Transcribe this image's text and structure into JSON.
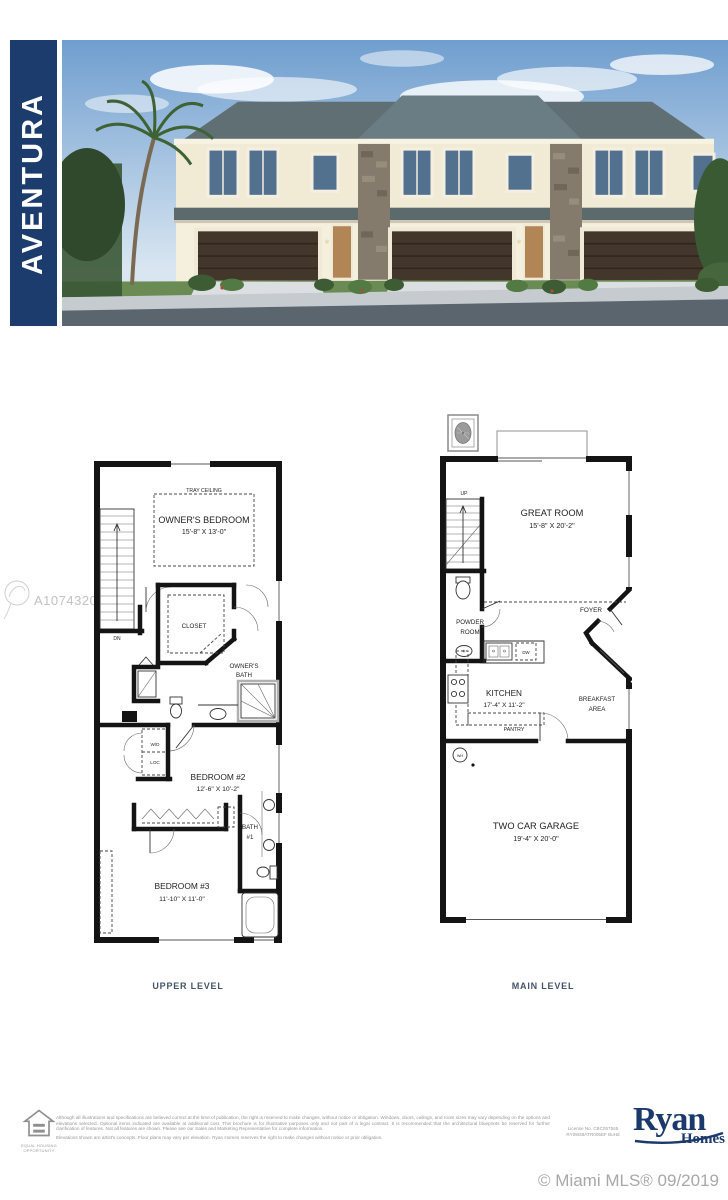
{
  "page": {
    "title_banner": "AVENTURA"
  },
  "mls": {
    "watermark_id": "A10743204",
    "copyright": "© Miami MLS® 09/2019"
  },
  "plans": {
    "upper": {
      "caption": "UPPER LEVEL",
      "labels": {
        "tray_ceiling": "TRAY CEILING",
        "owners_bedroom": "OWNER'S BEDROOM",
        "owners_bedroom_dims": "15'-8\" X 13'-0\"",
        "dn": "DN",
        "closet": "CLOSET",
        "owners_bath_l1": "OWNER'S",
        "owners_bath_l2": "BATH",
        "wd": "W/D",
        "loc": "LOC",
        "bedroom2": "BEDROOM #2",
        "bedroom2_dims": "12'-6\" X 10'-2\"",
        "bath1_l1": "BATH",
        "bath1_l2": "#1",
        "bedroom3": "BEDROOM #3",
        "bedroom3_dims": "11'-10\" X 11'-0\""
      }
    },
    "main": {
      "caption": "MAIN LEVEL",
      "labels": {
        "up": "UP",
        "great_room": "GREAT ROOM",
        "great_room_dims": "15'-8\" X 20'-2\"",
        "powder_l1": "POWDER",
        "powder_l2": "ROOM",
        "foyer": "FOYER",
        "kitchen": "KITCHEN",
        "kitchen_dims": "17'-4\" X 11'-2\"",
        "dw": "DW",
        "pantry": "PANTRY",
        "breakfast_l1": "BREAKFAST",
        "breakfast_l2": "AREA",
        "wh": "WH",
        "garage": "TWO CAR GARAGE",
        "garage_dims": "19'-4\" X 20'-0\""
      }
    }
  },
  "footer": {
    "disclaimer_p1": "Although all illustrations and specifications are believed correct at the time of publication, the right is reserved to make changes, without notice or obligation. Windows, doors, ceilings, and room sizes may vary depending on the options and elevations selected. Optional items indicated are available at additional cost. This brochure is for illustrative purposes only and not part of a legal contract. It is recommended that the architectural blueprints be reserved for further clarification of features. Not all features are shown. Please see our Sales and Marketing Representative for complete information.",
    "disclaimer_p2": "Elevations shown are artist's concepts. Floor plans may vary per elevation. Ryan Homes reserves the right to make changes without notice or prior obligation.",
    "license_l1": "License No. CBC057565",
    "license_l2": "RY09GBATR005EF BuHd",
    "brand_l1": "Ryan",
    "brand_l2": "Homes",
    "equal_housing_caption": "EQUAL HOUSING OPPORTUNITY"
  },
  "colors": {
    "banner_blue": "#1d3c6e",
    "brand_navy": "#1b3a6b",
    "caption_slate": "#44546a",
    "watermark_gray": "#c2c2c2",
    "mls_gray": "#a8a8a8"
  }
}
